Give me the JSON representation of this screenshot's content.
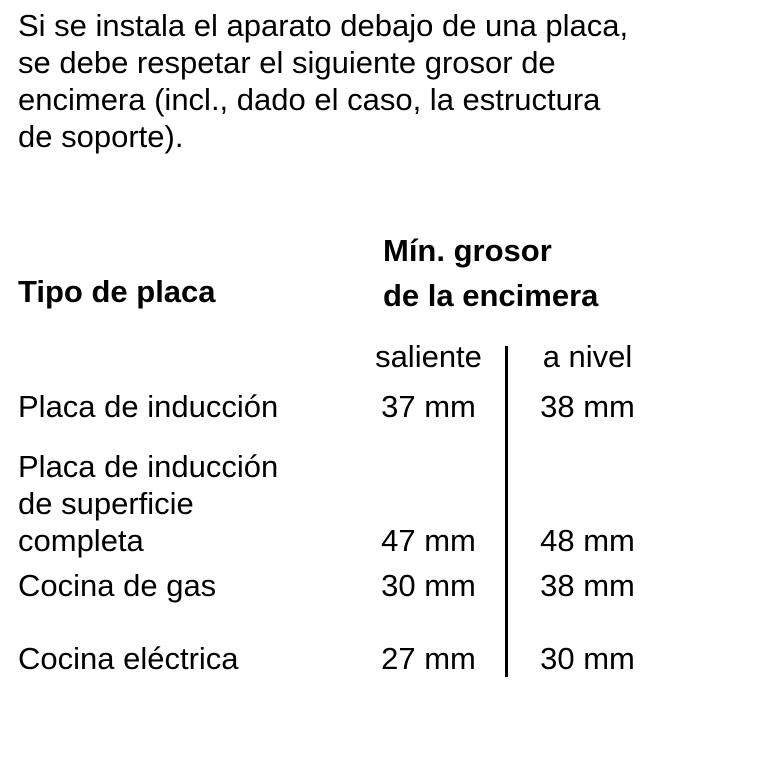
{
  "intro": {
    "lines": [
      "Si se instala el aparato debajo de una placa,",
      "se debe respetar el siguiente grosor de",
      "encimera (incl., dado el caso, la estructura",
      "de soporte)."
    ]
  },
  "table": {
    "col1_header": "Tipo de placa",
    "col23_header_lines": [
      "Mín. grosor",
      "de la encimera"
    ],
    "sub_headers": {
      "saliente": "saliente",
      "a_nivel": "a nivel"
    },
    "rows": [
      {
        "label_lines": [
          "Placa de inducción"
        ],
        "saliente": "37 mm",
        "a_nivel": "38 mm"
      },
      {
        "label_lines": [
          "Placa de inducción",
          "de superficie",
          "completa"
        ],
        "saliente": "47 mm",
        "a_nivel": "48 mm"
      },
      {
        "label_lines": [
          "Cocina de gas"
        ],
        "saliente": "30 mm",
        "a_nivel": "38 mm"
      },
      {
        "label_lines": [
          "Cocina eléctrica"
        ],
        "saliente": "27 mm",
        "a_nivel": "30 mm"
      }
    ]
  },
  "colors": {
    "text": "#000000",
    "background": "#ffffff",
    "divider": "#000000"
  }
}
